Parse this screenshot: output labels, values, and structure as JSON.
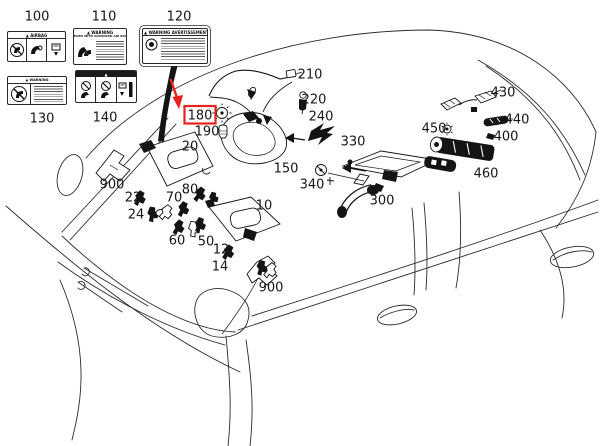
{
  "colors": {
    "highlight": "#e8231f",
    "line": "#2b2b2b",
    "ink": "#141414"
  },
  "warning_labels": [
    {
      "id": "100",
      "header": "▲ AIRBAG"
    },
    {
      "id": "110",
      "header": "▲ WARNING",
      "subheader": "EVEN WITH ADVANCED AIR BAGS"
    },
    {
      "id": "120",
      "header": "▲ WARNING  AVERTISSEMENT ■"
    },
    {
      "id": "130",
      "header": "▲  WARNING"
    },
    {
      "id": "140",
      "header": "▲"
    }
  ],
  "diagram": {
    "description": "Vehicle interior overhead equipment parts diagram",
    "callouts": [
      {
        "label": "100",
        "x": 37,
        "y": 16,
        "highlighted": false
      },
      {
        "label": "110",
        "x": 104,
        "y": 16,
        "highlighted": false
      },
      {
        "label": "120",
        "x": 179,
        "y": 16,
        "highlighted": false
      },
      {
        "label": "130",
        "x": 42,
        "y": 118,
        "highlighted": false
      },
      {
        "label": "140",
        "x": 105,
        "y": 117,
        "highlighted": false
      },
      {
        "label": "210",
        "x": 310,
        "y": 74,
        "highlighted": false
      },
      {
        "label": "220",
        "x": 314,
        "y": 99,
        "highlighted": false
      },
      {
        "label": "240",
        "x": 321,
        "y": 116,
        "highlighted": false
      },
      {
        "label": "180",
        "x": 200,
        "y": 115,
        "highlighted": true
      },
      {
        "label": "190",
        "x": 207,
        "y": 131,
        "highlighted": false
      },
      {
        "label": "150",
        "x": 286,
        "y": 168,
        "highlighted": false
      },
      {
        "label": "340",
        "x": 312,
        "y": 184,
        "highlighted": false
      },
      {
        "label": "330",
        "x": 353,
        "y": 141,
        "highlighted": false
      },
      {
        "label": "300",
        "x": 382,
        "y": 200,
        "highlighted": false
      },
      {
        "label": "430",
        "x": 503,
        "y": 92,
        "highlighted": false
      },
      {
        "label": "440",
        "x": 517,
        "y": 119,
        "highlighted": false
      },
      {
        "label": "450",
        "x": 434,
        "y": 128,
        "highlighted": false
      },
      {
        "label": "400",
        "x": 506,
        "y": 136,
        "highlighted": false
      },
      {
        "label": "460",
        "x": 486,
        "y": 173,
        "highlighted": false
      },
      {
        "label": "20",
        "x": 190,
        "y": 146,
        "highlighted": false
      },
      {
        "label": "900",
        "x": 112,
        "y": 184,
        "highlighted": false
      },
      {
        "label": "22",
        "x": 133,
        "y": 197,
        "highlighted": false
      },
      {
        "label": "24",
        "x": 136,
        "y": 214,
        "highlighted": false
      },
      {
        "label": "70",
        "x": 174,
        "y": 197,
        "highlighted": false
      },
      {
        "label": "80",
        "x": 190,
        "y": 189,
        "highlighted": false
      },
      {
        "label": "60",
        "x": 177,
        "y": 240,
        "highlighted": false
      },
      {
        "label": "50",
        "x": 206,
        "y": 241,
        "highlighted": false
      },
      {
        "label": "12",
        "x": 221,
        "y": 249,
        "highlighted": false
      },
      {
        "label": "14",
        "x": 220,
        "y": 266,
        "highlighted": false
      },
      {
        "label": "10",
        "x": 264,
        "y": 205,
        "highlighted": false
      },
      {
        "label": "900",
        "x": 271,
        "y": 287,
        "highlighted": false
      }
    ]
  }
}
